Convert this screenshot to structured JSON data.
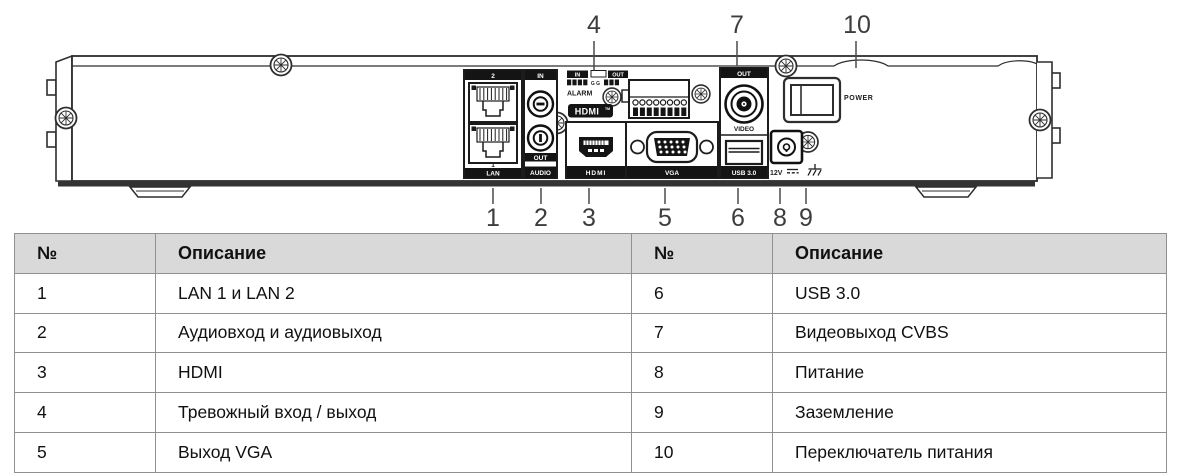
{
  "colors": {
    "outline": "#2e2e2e",
    "bar_black": "#141414",
    "leader": "#4a4a4a",
    "table_border": "#909090",
    "table_header_bg": "#d9d9d9"
  },
  "diagram": {
    "callouts": {
      "c1": "1",
      "c2": "2",
      "c3": "3",
      "c4": "4",
      "c5": "5",
      "c6": "6",
      "c7": "7",
      "c8": "8",
      "c9": "9",
      "c10": "10"
    },
    "labels": {
      "lan_port_2": "2",
      "lan_port_1": "1",
      "lan": "LAN",
      "audio_in": "IN",
      "audio_out": "OUT",
      "audio": "AUDIO",
      "alarm_in": "IN",
      "alarm_out": "OUT",
      "alarm_gg": "G G",
      "alarm": "ALARM",
      "hdmi_logo": "HDMI",
      "hdmi_tm": "TM",
      "hdmi": "HDMI",
      "vga": "VGA",
      "video_out": "OUT",
      "video": "VIDEO",
      "usb": "USB 3.0",
      "dc": "12V",
      "power": "POWER"
    }
  },
  "table": {
    "headers": [
      "№",
      "Описание",
      "№",
      "Описание"
    ],
    "rows": [
      [
        "1",
        "LAN 1 и LAN 2",
        "6",
        "USB 3.0"
      ],
      [
        "2",
        "Аудиовход и аудиовыход",
        "7",
        "Видеовыход CVBS"
      ],
      [
        "3",
        "HDMI",
        "8",
        "Питание"
      ],
      [
        "4",
        "Тревожный вход / выход",
        "9",
        "Заземление"
      ],
      [
        "5",
        "Выход VGA",
        "10",
        "Переключатель питания"
      ]
    ]
  }
}
